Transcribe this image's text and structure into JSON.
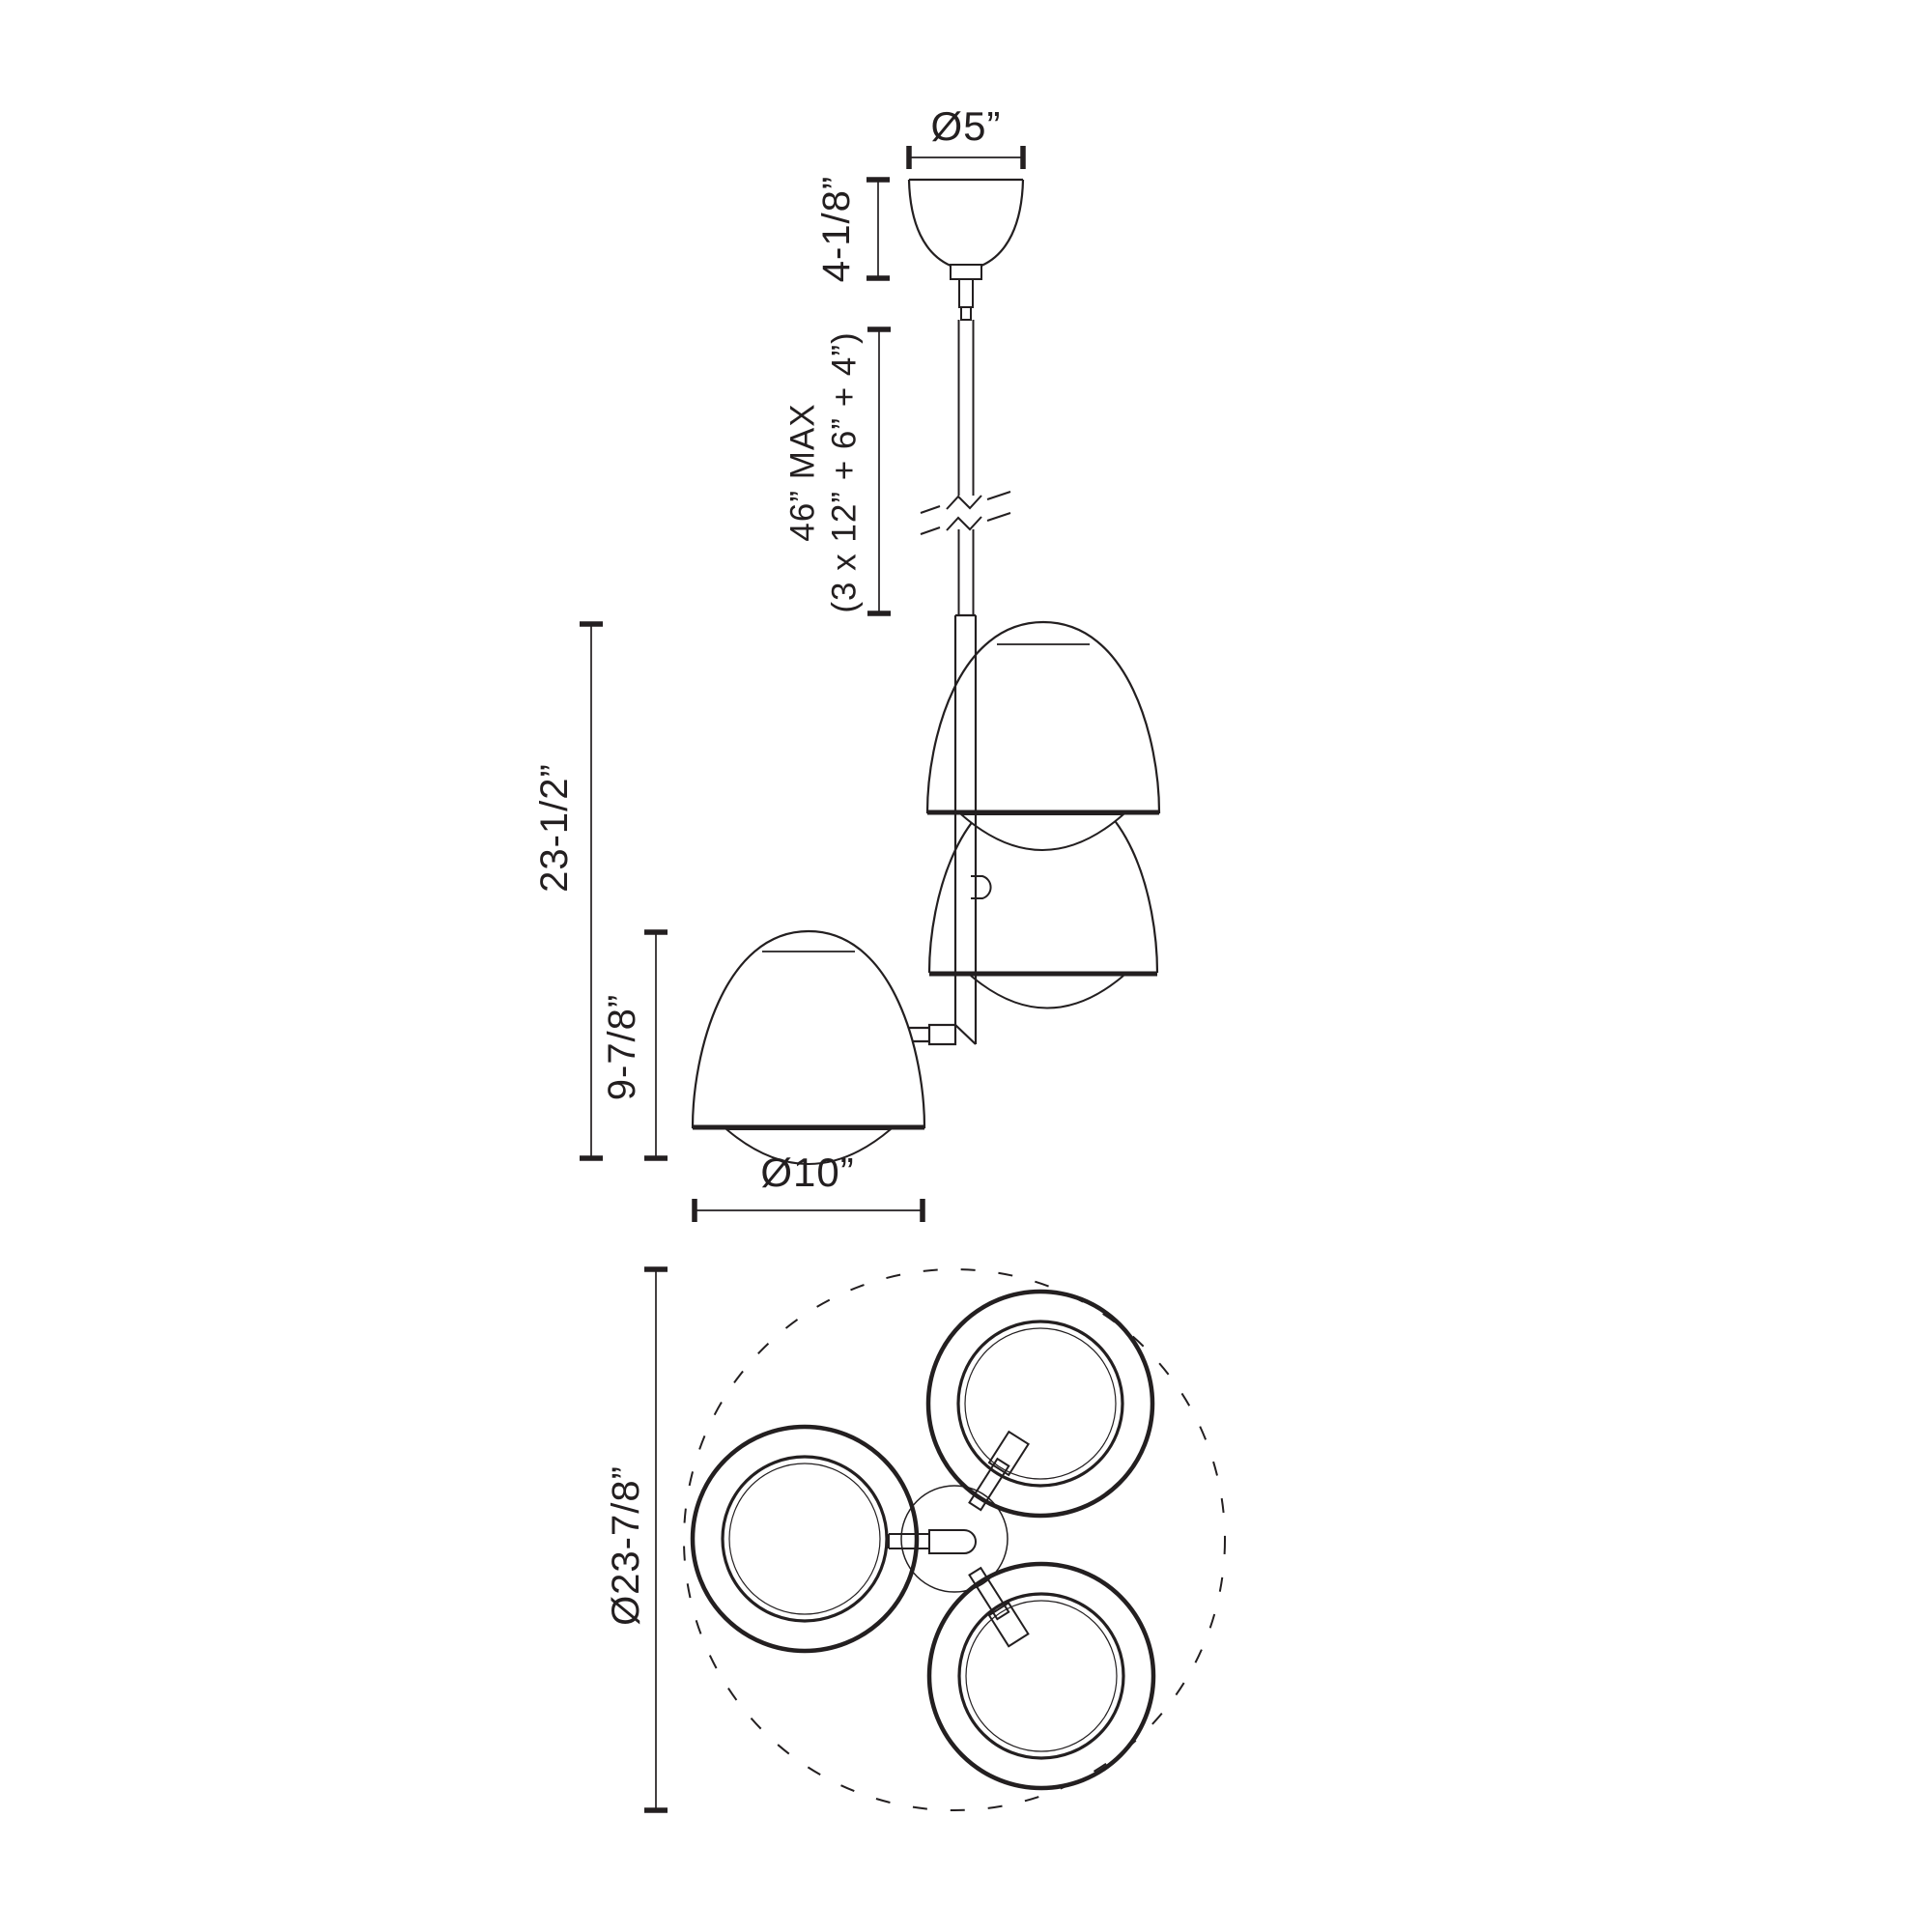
{
  "meta": {
    "background_color": "#ffffff",
    "line_color": "#231f20",
    "drawing_type": "pendant light fixture dimension drawing"
  },
  "front_view": {
    "canopy_diameter_label": "Ø5”",
    "canopy_height_label": "4-1/8”",
    "stem_max_label_line1": "46” MAX",
    "stem_max_label_line2": "(3 x 12” + 6” + 4”)",
    "fixture_height_label": "23-1/2”",
    "shade_height_label": "9-7/8”",
    "shade_diameter_label": "Ø10”"
  },
  "top_view": {
    "spread_diameter_label": "Ø23-7/8”"
  }
}
